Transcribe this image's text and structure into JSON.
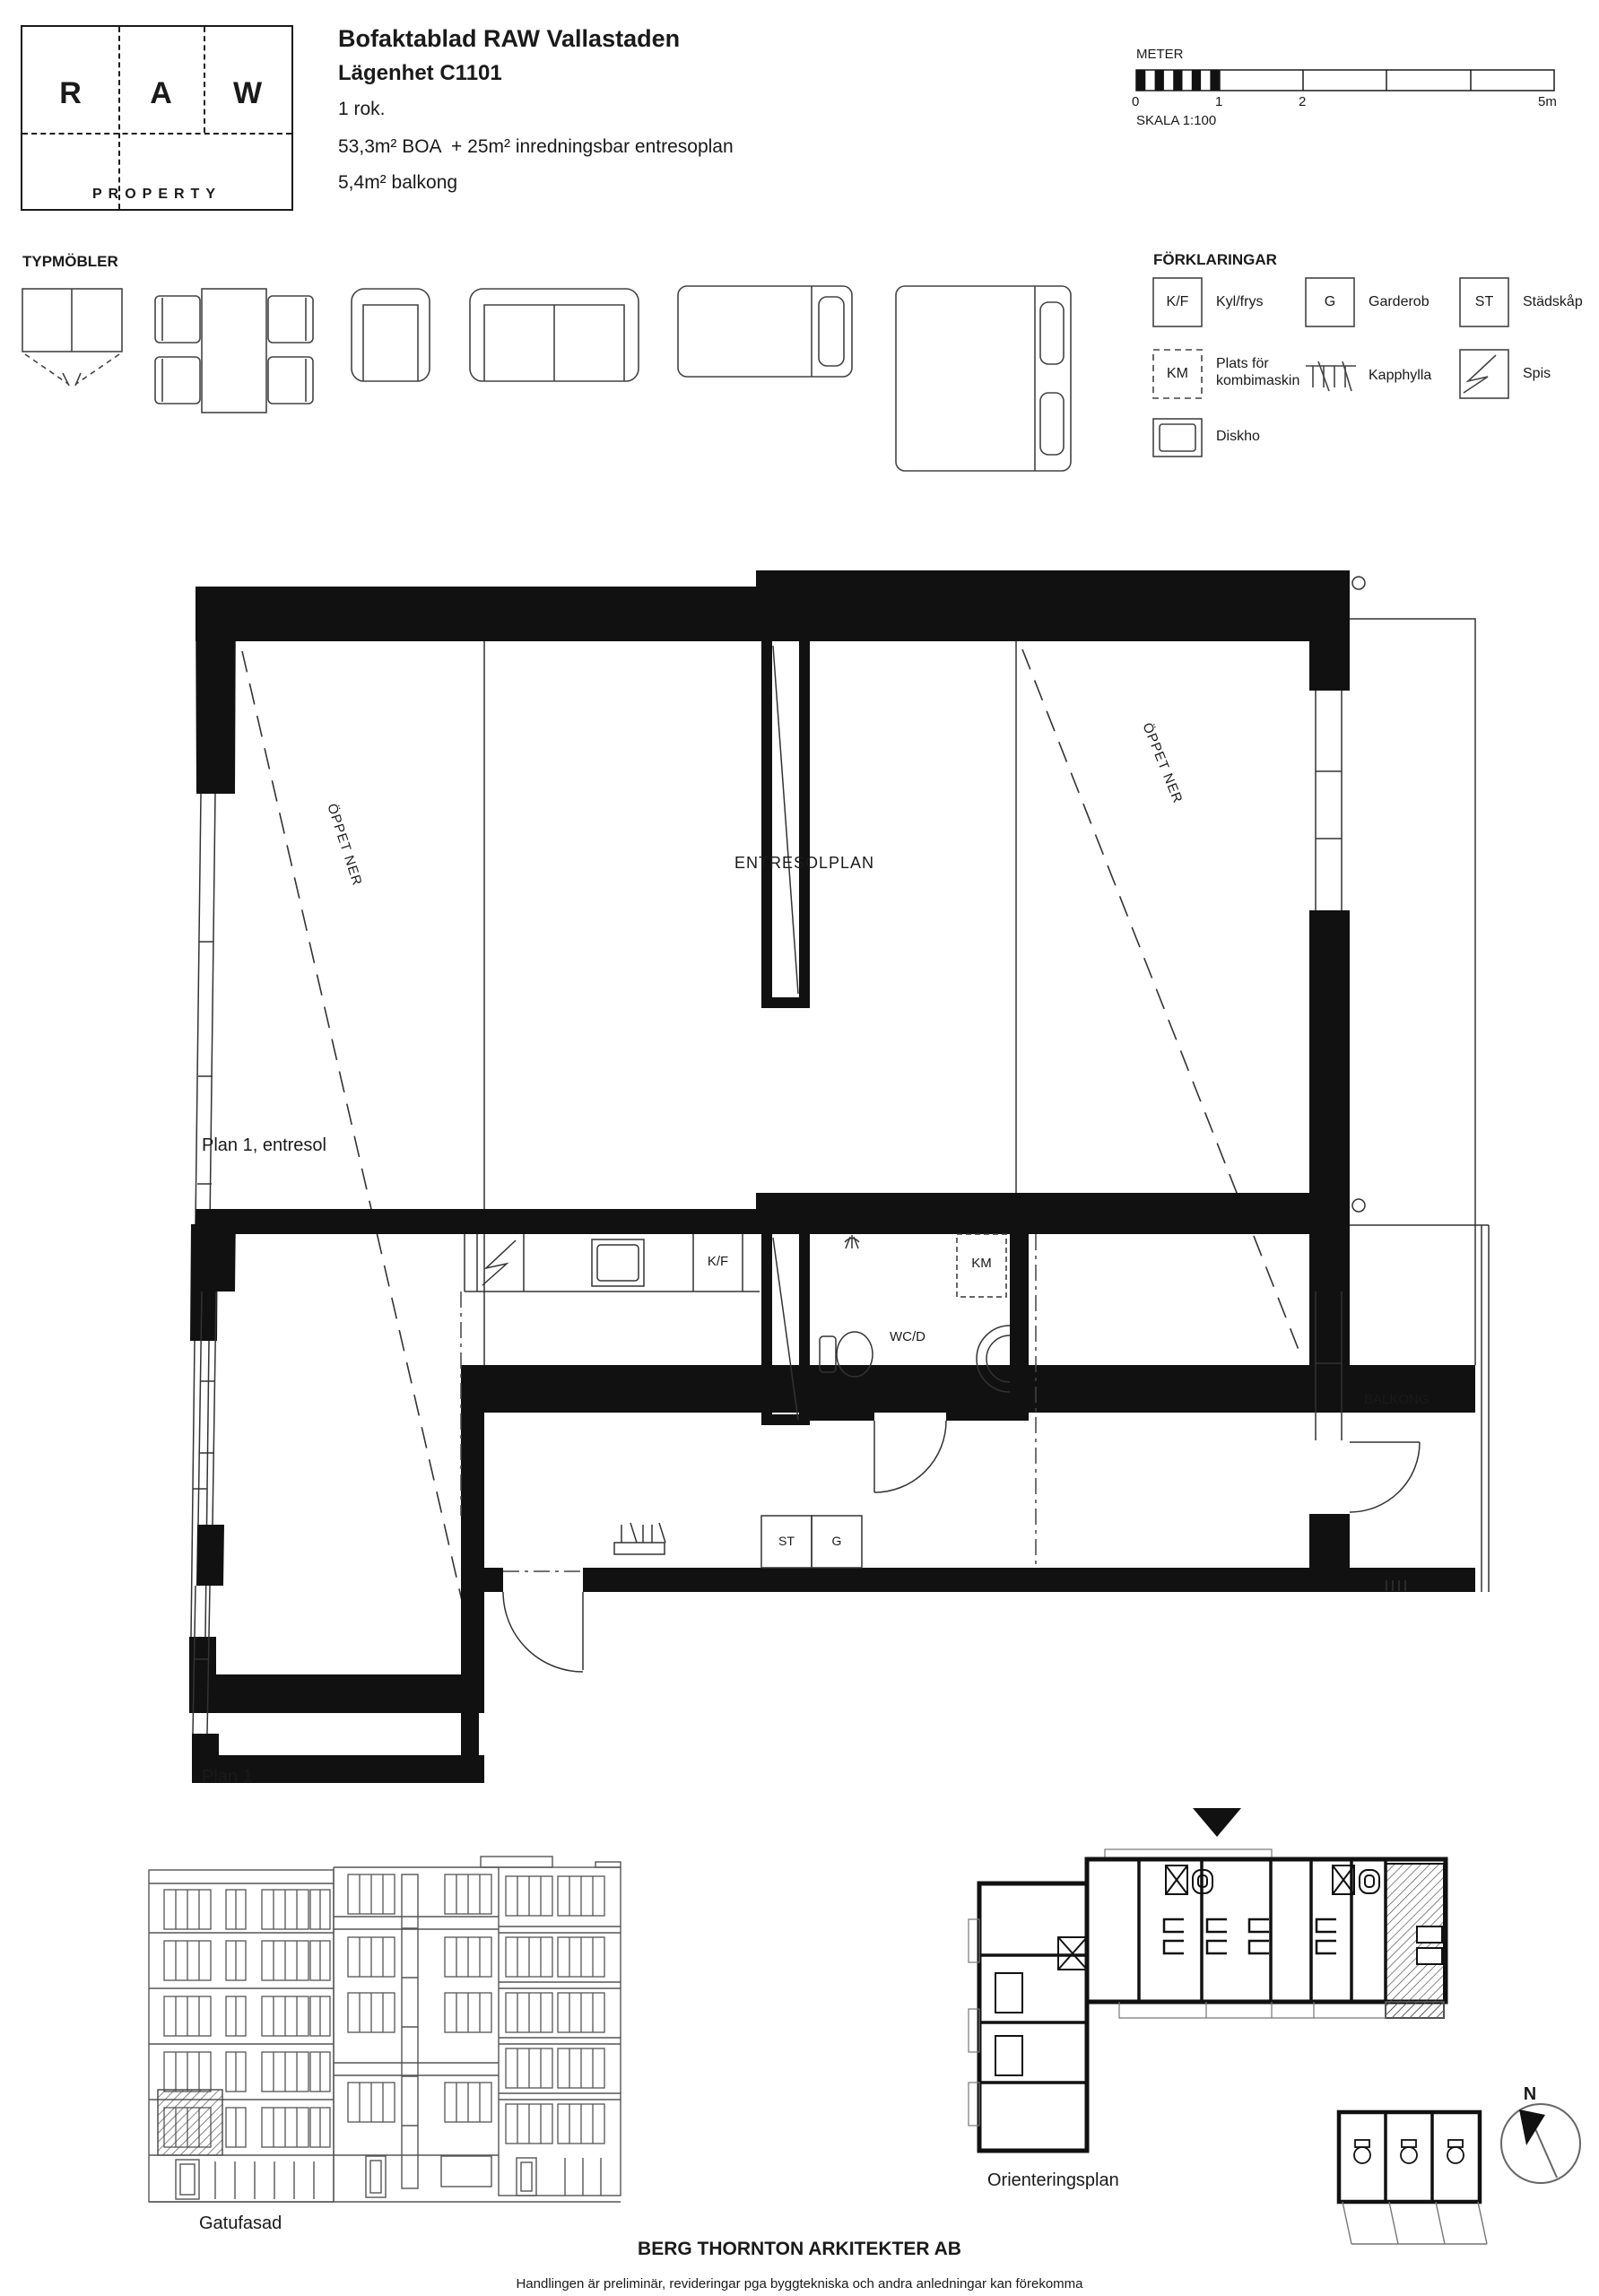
{
  "page": {
    "background": "#ffffff",
    "line_color": "#1a1a1a"
  },
  "logo": {
    "letter_r": "R",
    "letter_a": "A",
    "letter_w": "W",
    "word": "PROPERTY"
  },
  "header": {
    "title": "Bofaktablad RAW Vallastaden",
    "apartment": "Lägenhet C1101",
    "rooms": "1 rok.",
    "area": "53,3m² BOA  + 25m² inredningsbar entresoplan",
    "balcony": "5,4m² balkong"
  },
  "scalebar": {
    "unit_label": "METER",
    "ticks": [
      "0",
      "1",
      "2",
      "5m"
    ],
    "scale_label": "SKALA 1:100"
  },
  "furniture": {
    "heading": "TYPMÖBLER"
  },
  "legend": {
    "heading": "FÖRKLARINGAR",
    "items": [
      {
        "symbol": "K/F",
        "label": "Kyl/frys"
      },
      {
        "symbol": "G",
        "label": "Garderob"
      },
      {
        "symbol": "ST",
        "label": "Städskåp"
      },
      {
        "symbol": "KM",
        "label": "Plats för kombimaskin"
      },
      {
        "symbol": "",
        "label": "Kapphylla"
      },
      {
        "symbol": "",
        "label": "Spis"
      },
      {
        "symbol": "",
        "label": "Diskho"
      }
    ]
  },
  "entresol_plan": {
    "caption": "Plan 1, entresol",
    "room_label": "ENTRESOLPLAN",
    "open_below_left": "ÖPPET NER",
    "open_below_right": "ÖPPET NER"
  },
  "plan1": {
    "caption": "Plan 1",
    "labels": {
      "fridge": "K/F",
      "washer": "KM",
      "bathroom": "WC/D",
      "cleaning": "ST",
      "wardrobe": "G",
      "balcony": "BALKONG"
    }
  },
  "facade": {
    "caption": "Gatufasad"
  },
  "orientation": {
    "caption": "Orienteringsplan",
    "compass_north": "N"
  },
  "footer": {
    "architect": "BERG THORNTON ARKITEKTER AB",
    "disclaimer": "Handlingen är preliminär, revideringar pga byggtekniska och andra anledningar kan förekomma"
  }
}
